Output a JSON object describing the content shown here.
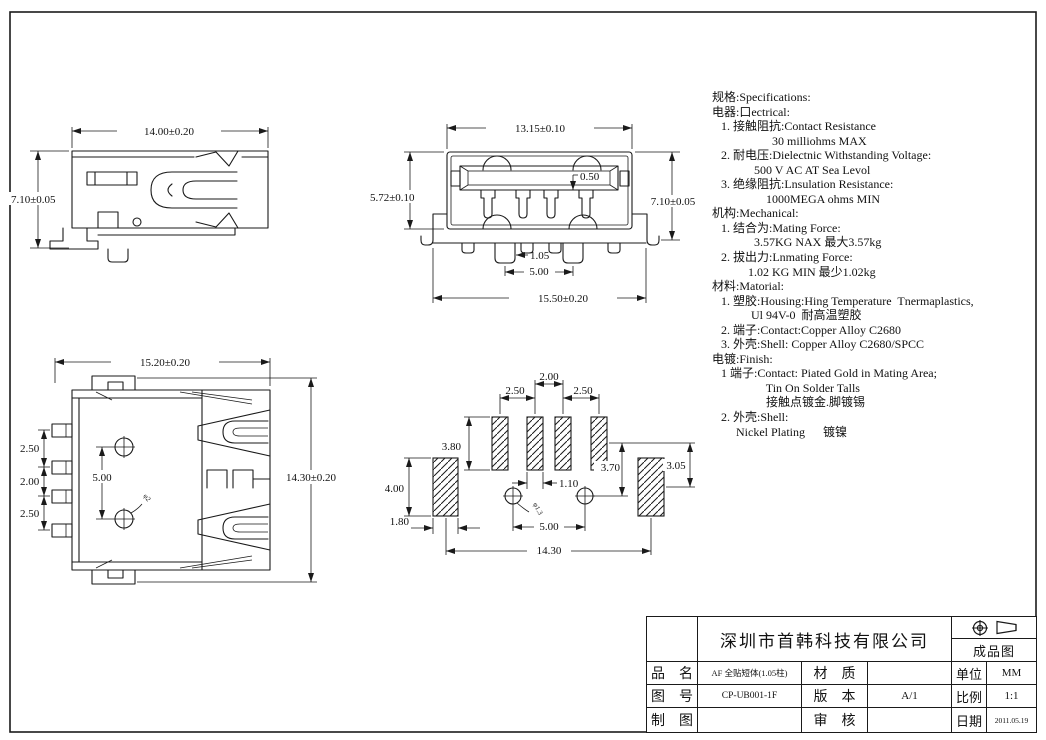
{
  "sheet": {
    "background": "#ffffff",
    "line_color": "#1a1a1a"
  },
  "views": {
    "side": {
      "width": "14.00±0.20",
      "height": "7.10±0.05"
    },
    "front": {
      "top_width": "13.15±0.10",
      "left_height": "5.72±0.10",
      "right_height": "7.10±0.05",
      "contact_width": "0.50",
      "peg_width": "1.05",
      "peg_pitch": "5.00",
      "bottom_width": "15.50±0.20"
    },
    "top": {
      "width": "15.20±0.20",
      "height": "14.30±0.20",
      "pin_pitch_a": "2.50",
      "pin_pitch_b": "2.00",
      "pin_pitch_c": "2.50",
      "peg_pitch": "5.00",
      "peg_diameter": "φ2"
    },
    "footprint": {
      "pad_pitch_center": "2.00",
      "pad_pitch_left": "2.50",
      "pad_pitch_right": "2.50",
      "pad_length": "3.80",
      "shell_pad_length": "4.00",
      "shell_pad_width": "1.80",
      "pad_width": "1.10",
      "hole_offset": "3.70",
      "shell_pad_offset": "3.05",
      "hole_diameter": "φ1.3",
      "hole_pitch": "5.00",
      "overall_width": "14.30"
    }
  },
  "specs": {
    "lines": [
      "规格:Specifications:",
      "电器:口ectrical:",
      "   1. 接触阻抗:Contact Resistance",
      "                    30 milliohms MAX",
      "   2. 耐电压:Dielectnic Withstanding Voltage:",
      "              500 V AC AT Sea Levol",
      "   3. 绝缘阻抗:Lnsulation Resistance:",
      "                  1000MEGA ohms MIN",
      "机构:Mechanical:",
      "   1. 结合为:Mating Force:",
      "              3.57KG NAX 最大3.57kg",
      "   2. 拔出力:Lnmating Force:",
      "            1.02 KG MIN 最少1.02kg",
      "材料:Matorial:",
      "   1. 塑胶:Housing:Hing Temperature  Tnermaplastics,",
      "             Ul 94V-0  耐高温塑胶",
      "   2. 端子:Contact:Copper Alloy C2680",
      "   3. 外壳:Shell: Copper Alloy C2680/SPCC",
      "电镀:Finish:",
      "   1 端子:Contact: Piated Gold in Mating Area;",
      "                  Tin On Solder Talls",
      "                  接触点镀金.脚镀锡",
      "   2. 外壳:Shell:",
      "        Nickel Plating      镀镍"
    ]
  },
  "title_block": {
    "company": "深圳市首韩科技有限公司",
    "drawing_type": "成品图",
    "part_name_label": "品　名",
    "part_name": "AF 全贴短体(1.05柱)",
    "material_label": "材　质",
    "material": "",
    "unit_label": "单位",
    "unit": "MM",
    "drawing_no_label": "图　号",
    "drawing_no": "CP-UB001-1F",
    "version_label": "版　本",
    "version": "A/1",
    "scale_label": "比例",
    "scale": "1:1",
    "drawn_label": "制　图",
    "drawn": "",
    "checked_label": "审　核",
    "checked": "",
    "date_label": "日期",
    "date": "2011.05.19"
  }
}
